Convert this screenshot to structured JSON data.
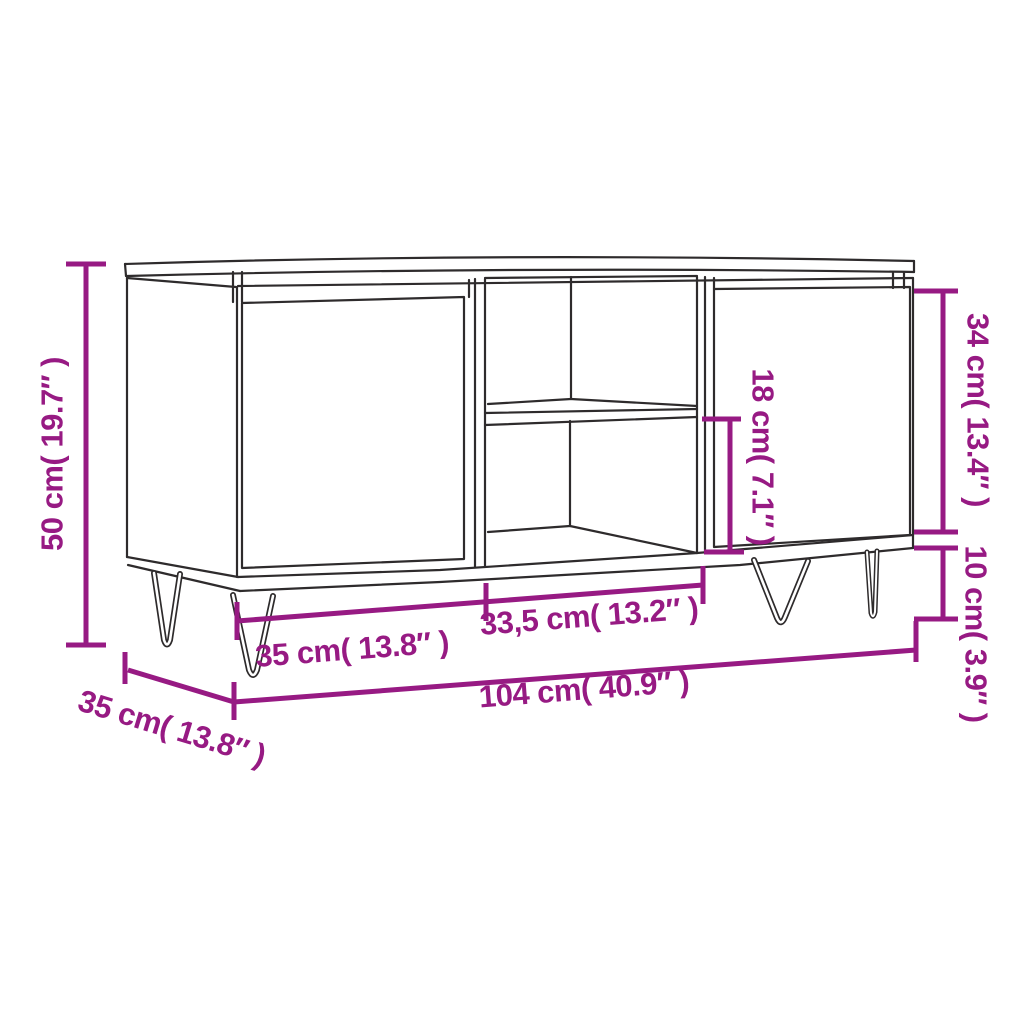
{
  "diagram": {
    "kind": "product-dimension-drawing",
    "subject": "TV cabinet with two doors, open middle compartment with shelf, and hairpin legs",
    "background": "#ffffff",
    "line_color": "#2e2b2c",
    "accent_color": "#971a83",
    "labels": {
      "height": "50 cm( 19.7″ )",
      "door_height": "34 cm( 13.4″ )",
      "leg_height": "10 cm( 3.9″ )",
      "opening_height": "18 cm( 7.1″ )",
      "left_door_width": "35 cm( 13.8″ )",
      "middle_width": "33,5 cm( 13.2″ )",
      "total_width": "104 cm( 40.9″ )",
      "depth": "35 cm( 13.8″ )"
    }
  }
}
